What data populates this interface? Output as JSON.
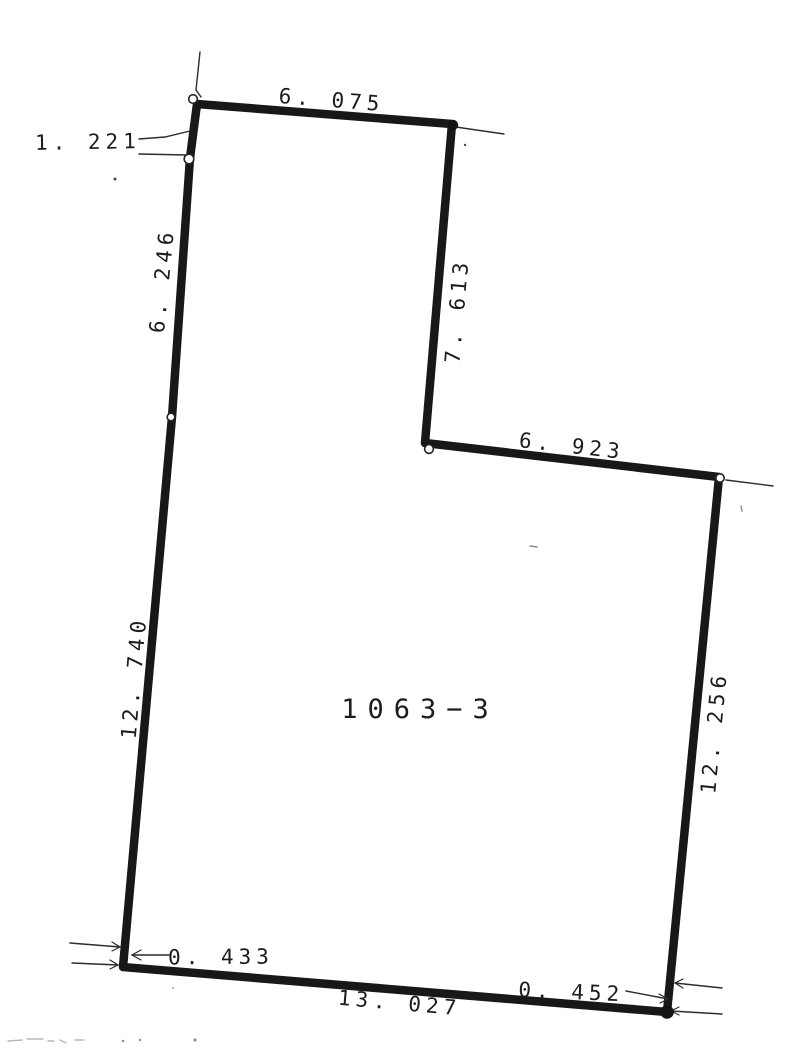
{
  "document": {
    "parcel_number": "1063−3",
    "ink_color": "#181818",
    "paper_color": "#ffffff",
    "dimensions": {
      "top_edge": "6. 075",
      "upper_left_offset": "1. 221",
      "left_upper_edge": "6. 246",
      "notch_right_edge": "7. 613",
      "step_edge": "6. 923",
      "left_lower_edge": "12. 740",
      "right_edge": "12. 256",
      "bottom_left_offset": "0. 433",
      "bottom_edge": "13. 027",
      "bottom_right_offset": "0. 452"
    }
  }
}
